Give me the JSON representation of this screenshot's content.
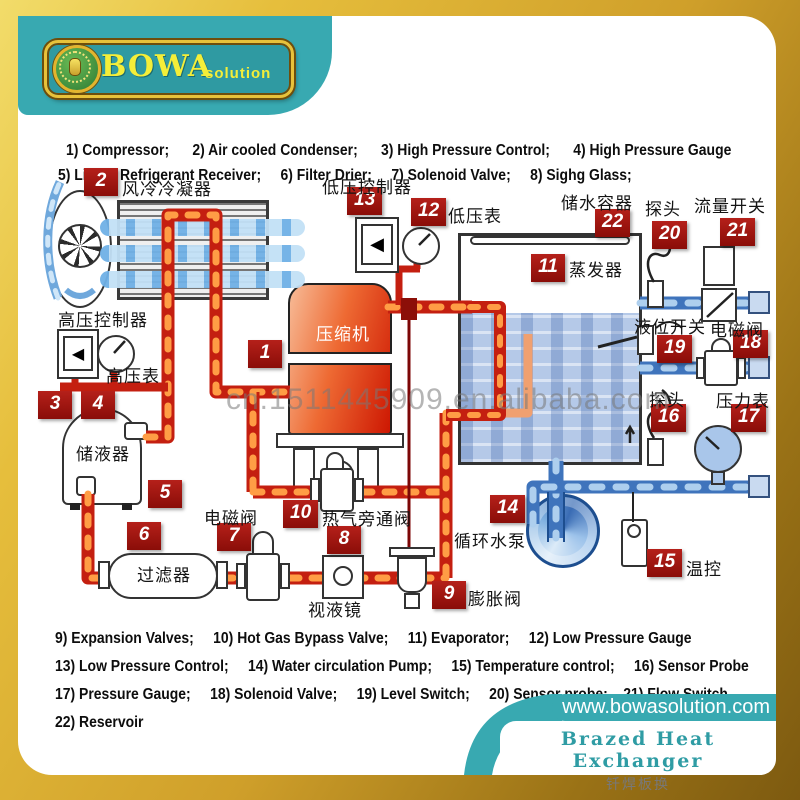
{
  "logo": {
    "brand": "BOWA",
    "suffix": "solution"
  },
  "legend_top": [
    "1) Compressor;      2) Air cooled Condenser;      3) High Pressure Control;      4) High Pressure Gauge",
    "5) Liquid Refrigerant Receiver;     6) Filter Drier;     7) Solenoid Valve;     8) Sighg Glass;"
  ],
  "legend_bottom": [
    "9) Expansion Valves;     10) Hot Gas Bypass Valve;     11) Evaporator;     12) Low Pressure Gauge",
    "13) Low Pressure Control;     14) Water circulation Pump;     15) Temperature control;     16) Sensor Probe",
    "17) Pressure Gauge;     18) Solenoid Valve;     19) Level Switch;     20) Sensor probe;    21) Flow Switch",
    "22) Reservoir"
  ],
  "watermark": "cn.1511445909.en.alibaba.com",
  "footer": {
    "url": "www.bowasolution.com",
    "product_en": "Brazed Heat Exchanger",
    "product_zh": "钎焊板换"
  },
  "colors": {
    "teal": "#38a9b1",
    "gold": "#cf9f2a",
    "badge_red": "#9b1410",
    "pipe_red": "#c41f10",
    "pipe_flame": "#ff9d45",
    "pipe_blue": "#3f74bc",
    "pipe_blue_light": "#aecfee"
  },
  "diagram": {
    "components": [
      {
        "num": 1,
        "zh": "压缩机",
        "en": "Compressor"
      },
      {
        "num": 2,
        "zh": "风冷冷凝器",
        "en": "Air cooled Condenser"
      },
      {
        "num": 3,
        "zh": "高压控制器",
        "en": "High Pressure Control"
      },
      {
        "num": 4,
        "zh": "高压表",
        "en": "High Pressure Gauge"
      },
      {
        "num": 5,
        "zh": "储液器",
        "en": "Liquid Refrigerant Receiver"
      },
      {
        "num": 6,
        "zh": "过滤器",
        "en": "Filter Drier"
      },
      {
        "num": 7,
        "zh": "电磁阀",
        "en": "Solenoid Valve"
      },
      {
        "num": 8,
        "zh": "视液镜",
        "en": "Sight Glass"
      },
      {
        "num": 9,
        "zh": "膨胀阀",
        "en": "Expansion Valves"
      },
      {
        "num": 10,
        "zh": "热气旁通阀",
        "en": "Hot Gas Bypass Valve"
      },
      {
        "num": 11,
        "zh": "蒸发器",
        "en": "Evaporator"
      },
      {
        "num": 12,
        "zh": "低压表",
        "en": "Low Pressure Gauge"
      },
      {
        "num": 13,
        "zh": "低压控制器",
        "en": "Low Pressure Control"
      },
      {
        "num": 14,
        "zh": "循环水泵",
        "en": "Water circulation Pump"
      },
      {
        "num": 15,
        "zh": "温控",
        "en": "Temperature control"
      },
      {
        "num": 16,
        "zh": "探头",
        "en": "Sensor Probe"
      },
      {
        "num": 17,
        "zh": "压力表",
        "en": "Pressure Gauge"
      },
      {
        "num": 18,
        "zh": "电磁阀",
        "en": "Solenoid Valve"
      },
      {
        "num": 19,
        "zh": "液位开关",
        "en": "Level Switch"
      },
      {
        "num": 20,
        "zh": "探头",
        "en": "Sensor probe"
      },
      {
        "num": 21,
        "zh": "流量开关",
        "en": "Flow Switch"
      },
      {
        "num": 22,
        "zh": "储水容器",
        "en": "Reservoir"
      }
    ]
  }
}
